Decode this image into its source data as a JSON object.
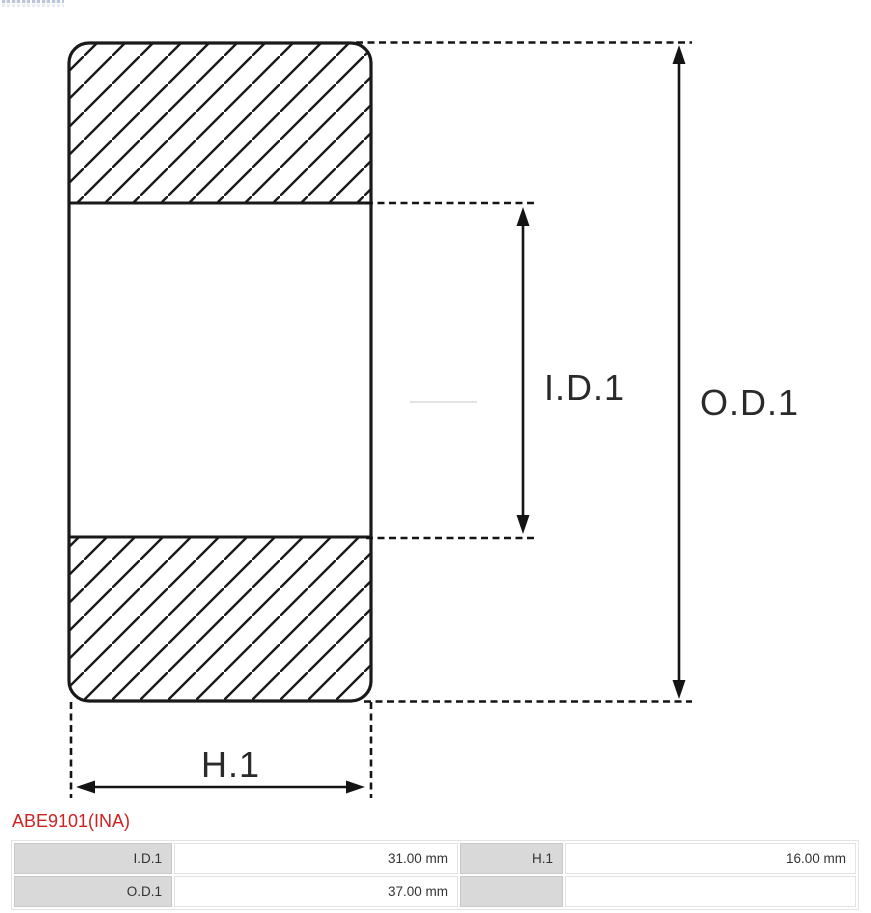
{
  "part_number": "ABE9101(INA)",
  "diagram": {
    "labels": {
      "inner_diameter": "I.D.1",
      "outer_diameter": "O.D.1",
      "height": "H.1"
    }
  },
  "spec_table": {
    "rows": [
      {
        "cells": [
          {
            "label": "I.D.1",
            "value": "31.00 mm"
          },
          {
            "label": "H.1",
            "value": "16.00 mm"
          }
        ]
      },
      {
        "cells": [
          {
            "label": "O.D.1",
            "value": "37.00 mm"
          },
          {
            "label": "",
            "value": ""
          }
        ]
      }
    ]
  },
  "colors": {
    "part_number_red": "#cc2222",
    "table_label_bg": "#d9d9d9",
    "line_stroke": "#141414"
  }
}
